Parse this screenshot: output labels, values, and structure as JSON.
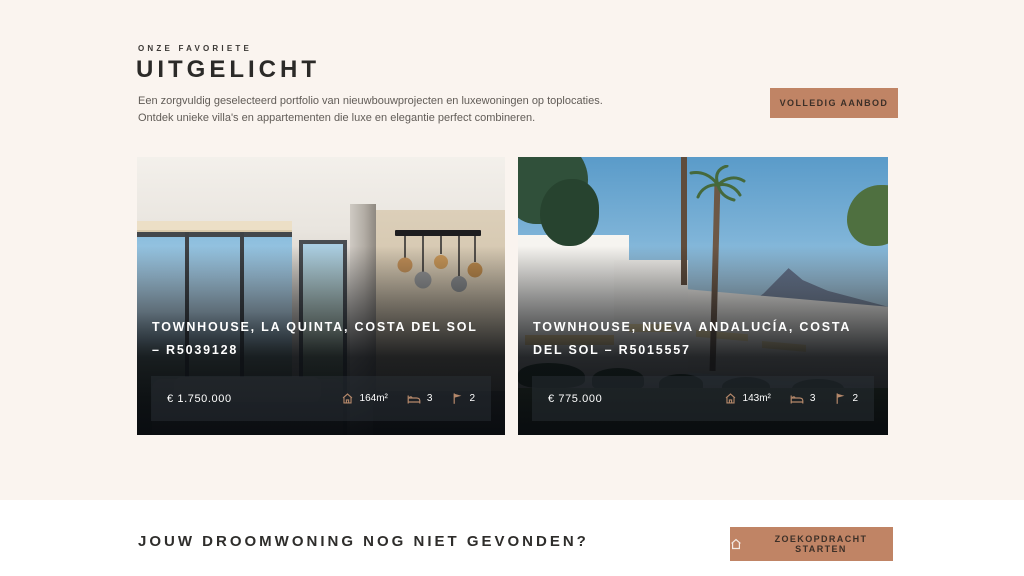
{
  "theme": {
    "accent": "#c08465",
    "page_background": "#faf4ef",
    "cta_background": "#ffffff",
    "heading_color": "#2b2a28",
    "muted_text": "#615c57",
    "card_icon_color": "#b5886a"
  },
  "featured": {
    "eyebrow": "ONZE FAVORIETE",
    "title": "UITGELICHT",
    "description": "Een zorgvuldig geselecteerd portfolio van nieuwbouwprojecten en luxewoningen op toplocaties. Ontdek unieke villa's en appartementen die luxe en elegantie perfect combineren.",
    "cta_label": "VOLLEDIG AANBOD",
    "cards": [
      {
        "title": "TOWNHOUSE, LA QUINTA, COSTA DEL SOL – R5039128",
        "price": "€ 1.750.000",
        "area": "164m²",
        "bedrooms": "3",
        "bathrooms": "2",
        "image": "interior-living-room-with-terrace-view"
      },
      {
        "title": "TOWNHOUSE, NUEVA ANDALUCÍA, COSTA DEL SOL – R5015557",
        "price": "€ 775.000",
        "area": "143m²",
        "bedrooms": "3",
        "bathrooms": "2",
        "image": "white-townhouses-palms-mountain"
      }
    ],
    "icons": {
      "area": "house-icon",
      "bedrooms": "bed-icon",
      "bathrooms": "flag-icon"
    }
  },
  "cta_section": {
    "title": "JOUW DROOMWONING NOG NIET GEVONDEN?",
    "button_label": "ZOEKOPDRACHT STARTEN",
    "button_icon": "home-icon"
  }
}
